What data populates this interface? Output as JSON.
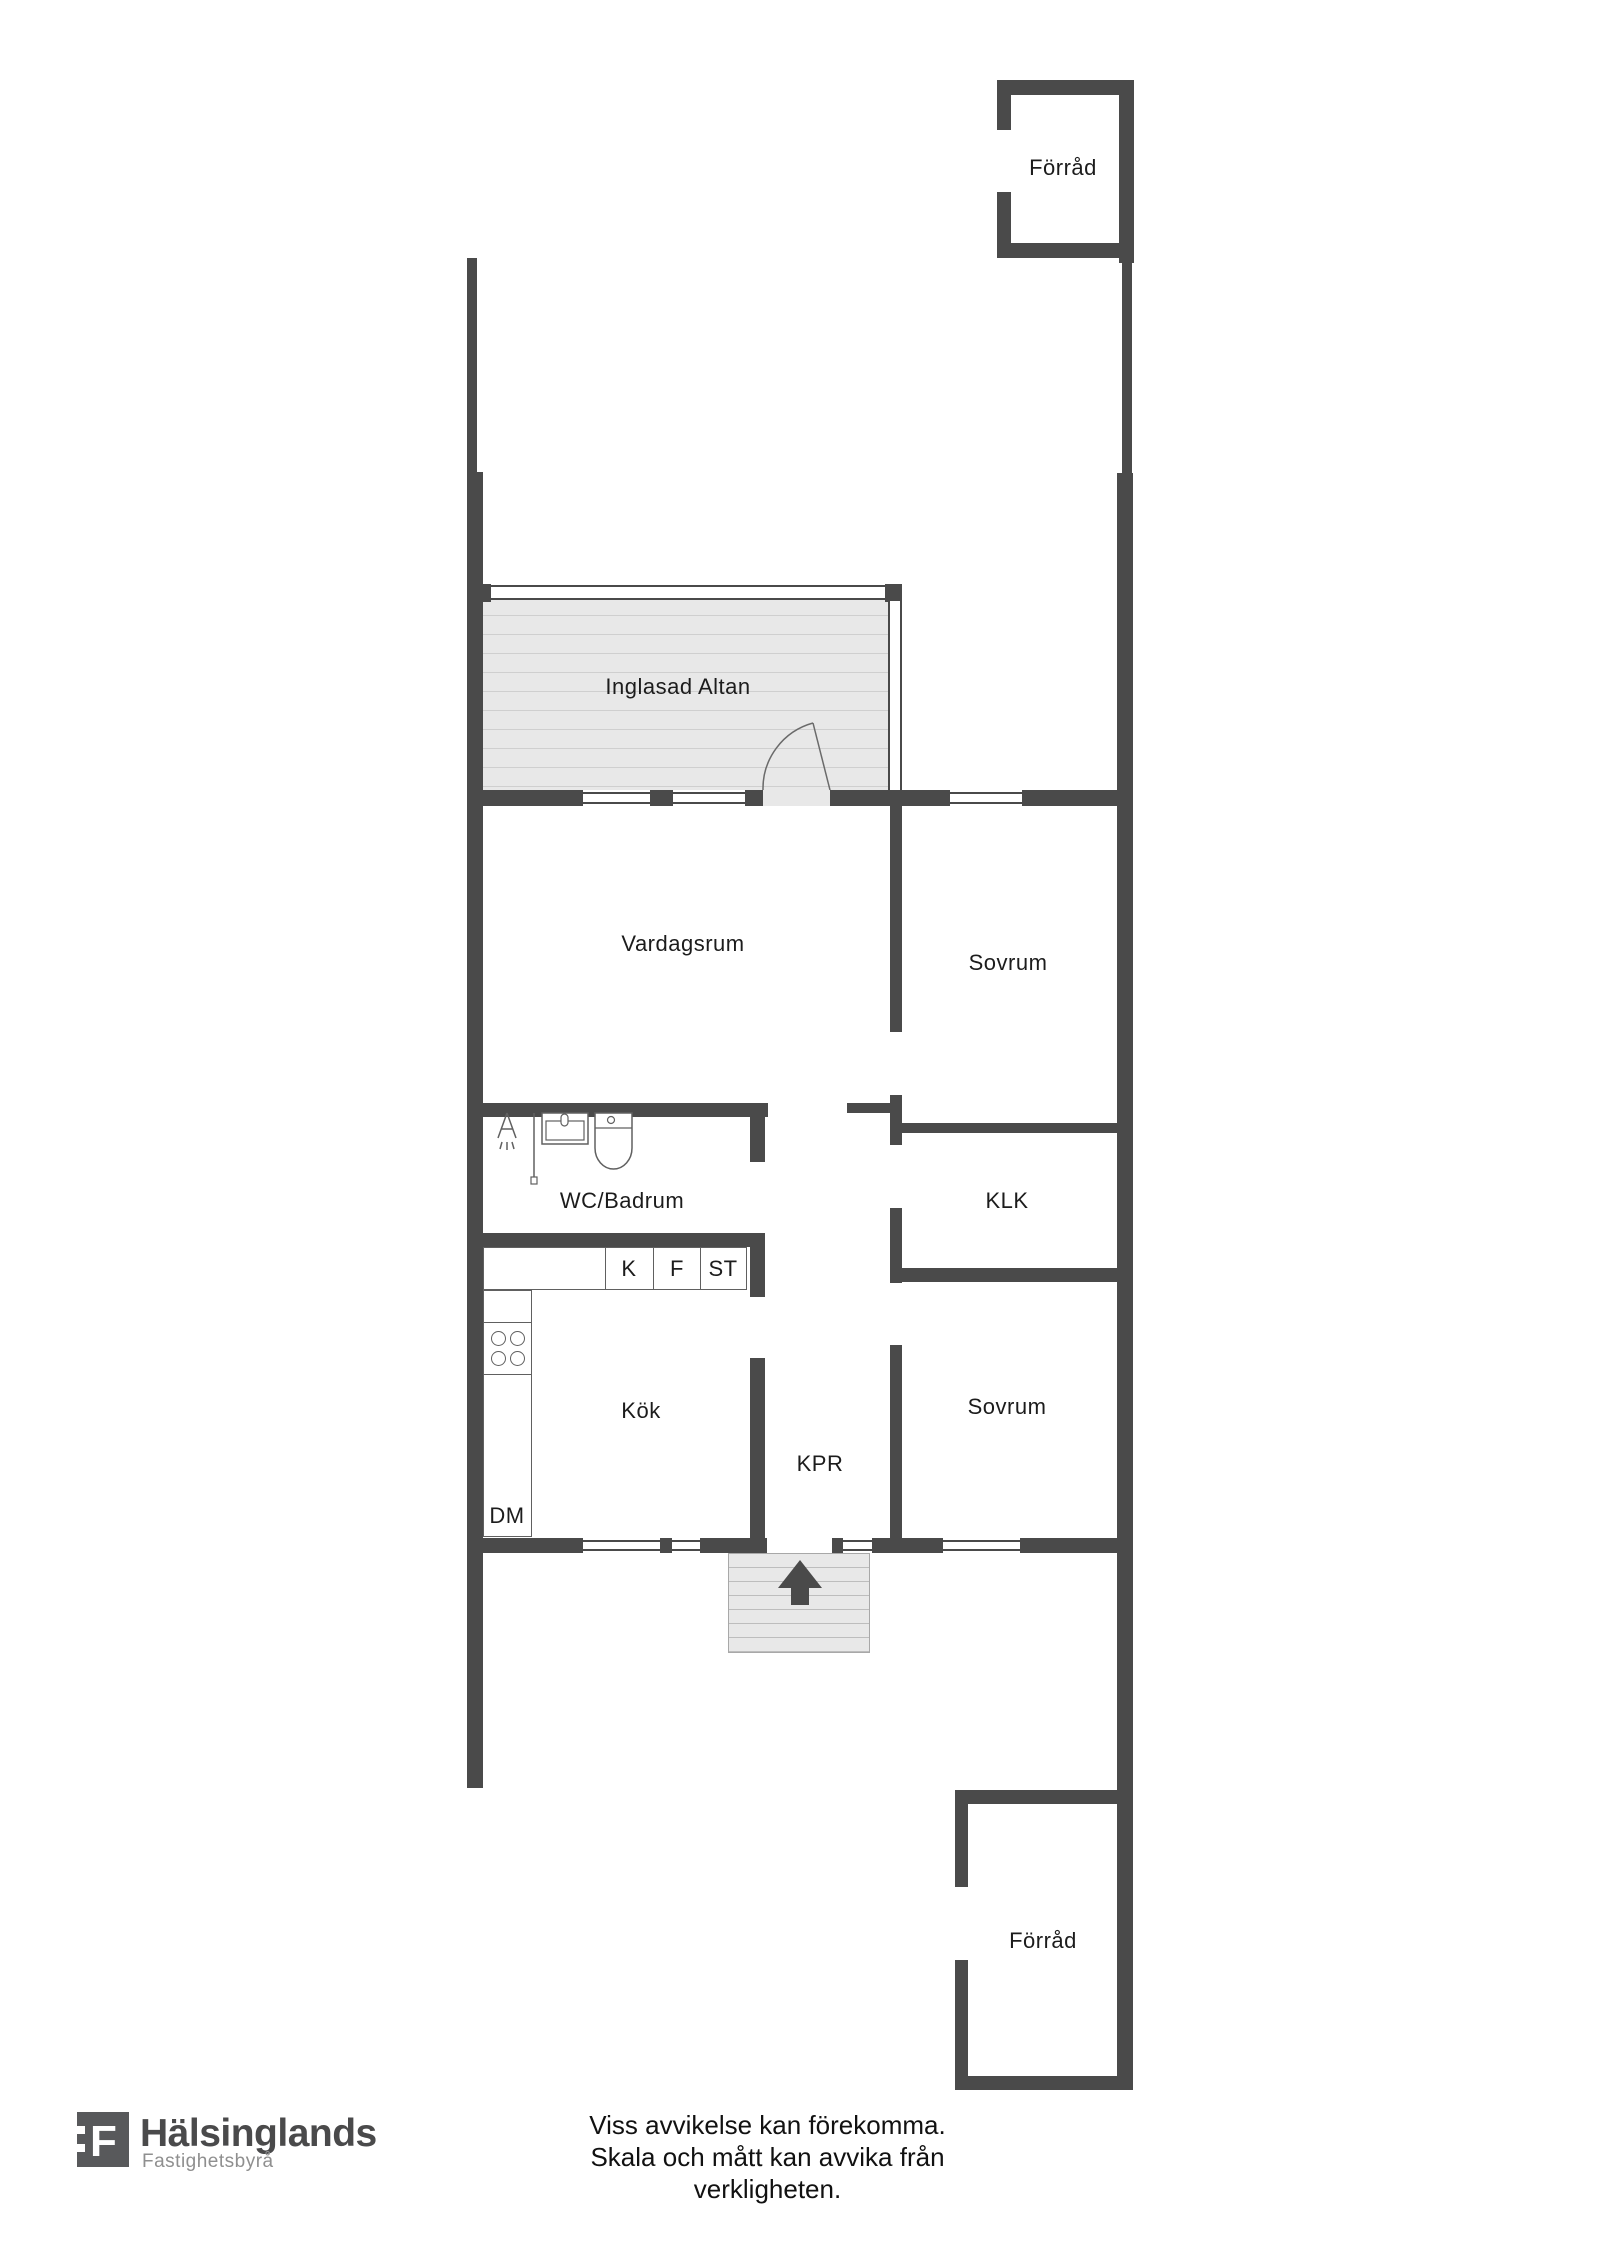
{
  "rooms": {
    "forrad_top": "Förråd",
    "inglasad_altan": "Inglasad Altan",
    "vardagsrum": "Vardagsrum",
    "sovrum1": "Sovrum",
    "wc_badrum": "WC/Badrum",
    "klk": "KLK",
    "kok": "Kök",
    "kpr": "KPR",
    "sovrum2": "Sovrum",
    "forrad_bottom": "Förråd"
  },
  "appliances": {
    "k": "K",
    "f": "F",
    "st": "ST",
    "dm": "DM"
  },
  "footer": {
    "logo_letter": "F",
    "brand": "Hälsinglands",
    "brand_sub": "Fastighetsbyrå",
    "disclaimer_line1": "Viss avvikelse kan förekomma.",
    "disclaimer_line2": "Skala och mått kan avvika från verkligheten."
  },
  "colors": {
    "wall": "#4a4a4a",
    "floor_fill": "#e8e8e8",
    "floor_stripe": "#cfcfcf",
    "fixture_line": "#606060",
    "logo_gray": "#58595b",
    "brand_sub_gray": "#8f8f8f"
  }
}
